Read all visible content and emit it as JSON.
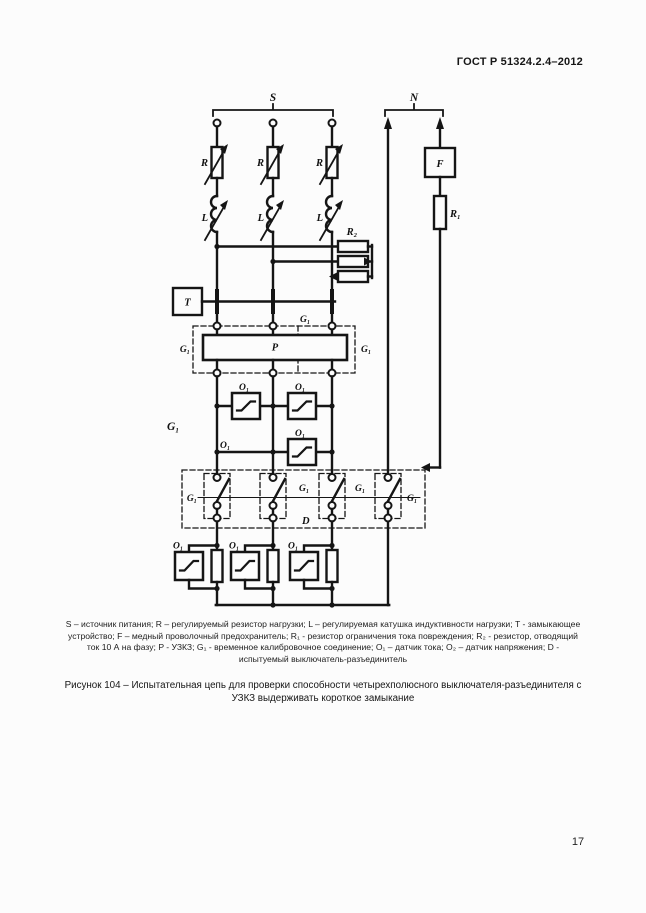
{
  "page": {
    "header": "ГОСТ Р 51324.2.4–2012",
    "page_number": "17"
  },
  "diagram": {
    "labels": {
      "s": "S",
      "n": "N",
      "r": "R",
      "l": "L",
      "r2": "R₂",
      "f": "F",
      "r1": "R₁",
      "t": "T",
      "p": "P",
      "g1": "G₁",
      "o1": "O₁",
      "d": "D"
    }
  },
  "legend": {
    "lines": [
      "S – источник питания; R – регулируемый резистор нагрузки; L – регулируемая катушка индуктивности нагрузки; T - замыкающее",
      "устройство; F – медный проволочный предохранитель; R₁ - резистор ограничения тока повреждения; R₂ - резистор, отводящий",
      "ток 10 А на фазу; P - УЗКЗ; G₁ - временное калибровочное соединение; O₁ – датчик тока; O₂ – датчик напряжения; D -",
      "испытуемый выключатель-разъединитель"
    ]
  },
  "caption": {
    "lines": [
      "Рисунок 104 – Испытательная цепь для проверки способности четырехполюсного выключателя-разъединителя с",
      "УЗКЗ выдерживать короткое замыкание"
    ]
  }
}
